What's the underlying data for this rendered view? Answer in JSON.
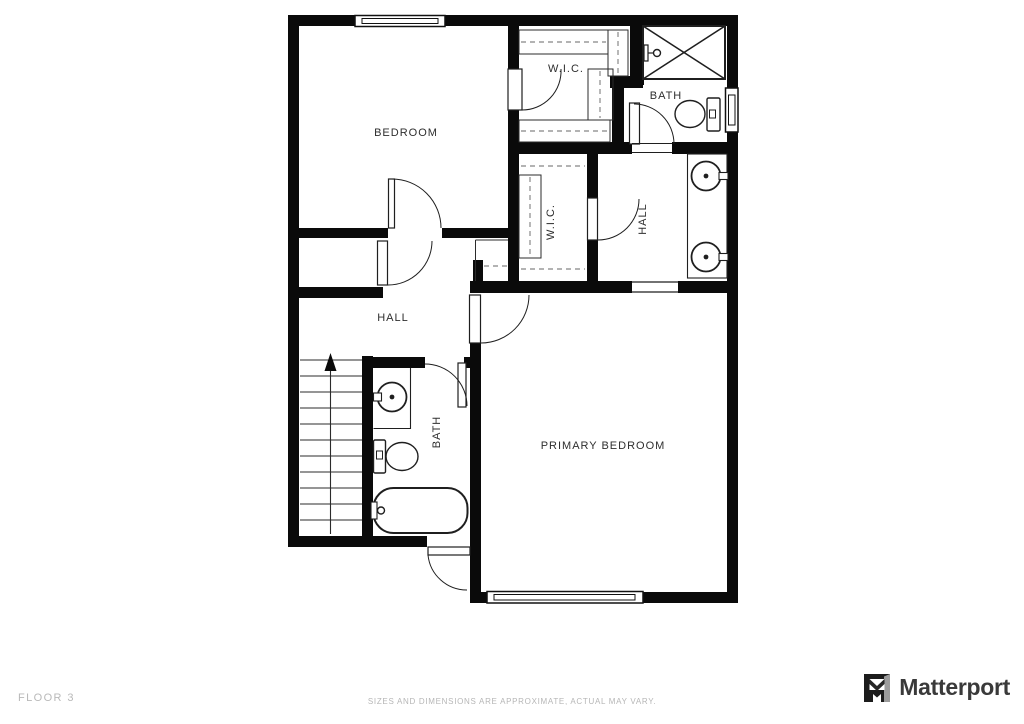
{
  "rooms": [
    {
      "id": "bedroom",
      "label": "BEDROOM"
    },
    {
      "id": "wic-top",
      "label": "W.I.C."
    },
    {
      "id": "bath-top",
      "label": "BATH"
    },
    {
      "id": "wic-middle",
      "label": "W.I.C."
    },
    {
      "id": "hall-right",
      "label": "HALL"
    },
    {
      "id": "hall-left",
      "label": "HALL"
    },
    {
      "id": "bath-left",
      "label": "BATH"
    },
    {
      "id": "primary-bedroom",
      "label": "PRIMARY BEDROOM"
    }
  ],
  "fixtures": [
    "shower",
    "toilet",
    "double-sink-vanity",
    "pedestal-sink",
    "toilet",
    "bathtub",
    "stairs-up"
  ],
  "footer": {
    "floor_label": "FLOOR 3",
    "disclaimer": "SIZES AND DIMENSIONS ARE APPROXIMATE, ACTUAL MAY VARY."
  },
  "brand": {
    "wordmark": "Matterport"
  },
  "colors": {
    "wall": "#0a0a0a",
    "fixture_line": "#1f1f1f",
    "dash": "#9a9a9a",
    "label": "#2e2e2e",
    "muted_text": "#b6b6b6",
    "brand_text": "#3a3a3a"
  }
}
